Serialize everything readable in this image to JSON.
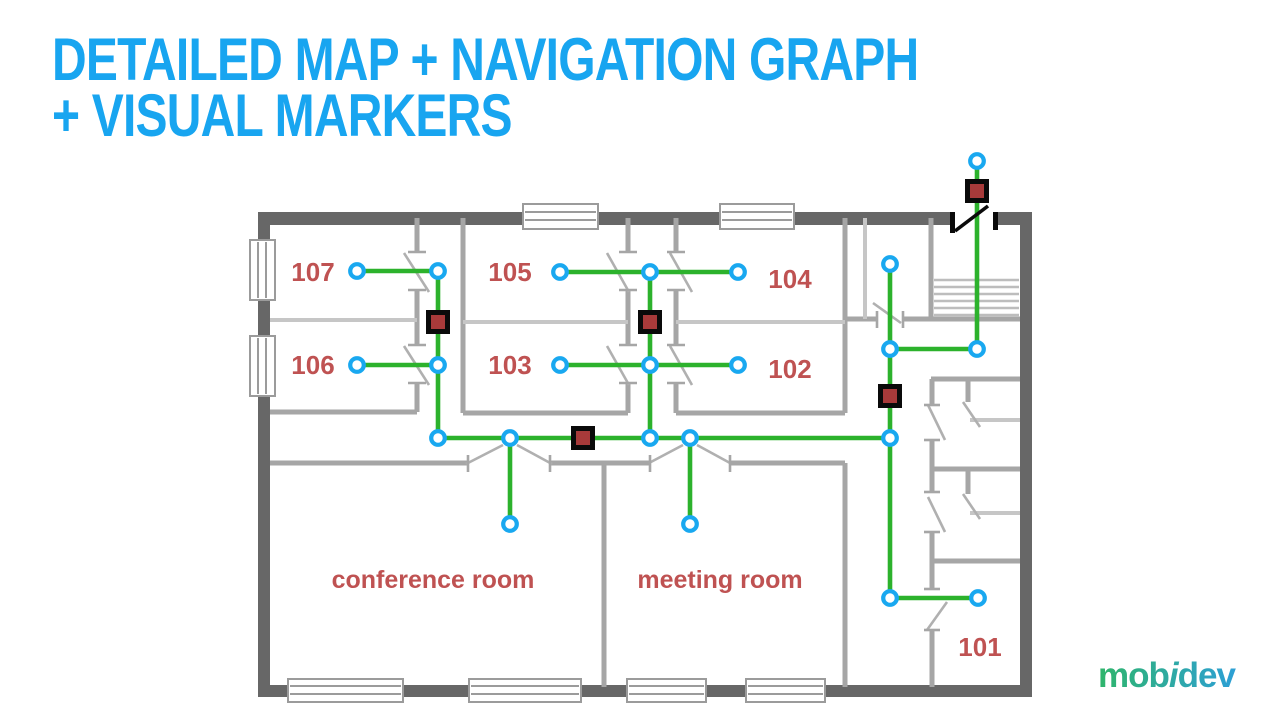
{
  "slide": {
    "title_line1": "DETAILED MAP + NAVIGATION GRAPH",
    "title_line2": "+ VISUAL MARKERS"
  },
  "logo": {
    "pre": "mob",
    "accent": "i",
    "post": "dev"
  },
  "colors": {
    "title": "#18a5f0",
    "edge": "#2cb22c",
    "node": "#19a8f0",
    "marker_fill": "#a83a3a",
    "marker_border": "#0a0a0a",
    "room_label": "#bf5252",
    "wall_outer": "#676767",
    "wall_inner": "#a6a6a6",
    "logo_green": "#2fb56b",
    "logo_blue": "#2d9fd6"
  },
  "map": {
    "room_labels": [
      {
        "id": "107",
        "text": "107",
        "x": 313,
        "y": 281,
        "size": 26
      },
      {
        "id": "106",
        "text": "106",
        "x": 313,
        "y": 374,
        "size": 26
      },
      {
        "id": "105",
        "text": "105",
        "x": 510,
        "y": 281,
        "size": 26
      },
      {
        "id": "103",
        "text": "103",
        "x": 510,
        "y": 374,
        "size": 26
      },
      {
        "id": "104",
        "text": "104",
        "x": 790,
        "y": 288,
        "size": 26
      },
      {
        "id": "102",
        "text": "102",
        "x": 790,
        "y": 378,
        "size": 26
      },
      {
        "id": "101",
        "text": "101",
        "x": 980,
        "y": 656,
        "size": 26
      },
      {
        "id": "conference-room",
        "text": "conference room",
        "x": 433,
        "y": 588,
        "size": 25
      },
      {
        "id": "meeting-room",
        "text": "meeting room",
        "x": 720,
        "y": 588,
        "size": 25
      }
    ],
    "nodes": [
      {
        "id": "room-107",
        "x": 357,
        "y": 271
      },
      {
        "id": "door-107",
        "x": 438,
        "y": 271
      },
      {
        "id": "room-106",
        "x": 357,
        "y": 365
      },
      {
        "id": "door-106",
        "x": 438,
        "y": 365
      },
      {
        "id": "room-105",
        "x": 560,
        "y": 272
      },
      {
        "id": "door-105",
        "x": 650,
        "y": 272
      },
      {
        "id": "room-104",
        "x": 738,
        "y": 272
      },
      {
        "id": "room-103",
        "x": 560,
        "y": 365
      },
      {
        "id": "door-103",
        "x": 650,
        "y": 365
      },
      {
        "id": "room-102",
        "x": 738,
        "y": 365
      },
      {
        "id": "corridor-left",
        "x": 438,
        "y": 438
      },
      {
        "id": "conference-door",
        "x": 510,
        "y": 438
      },
      {
        "id": "conference-inner",
        "x": 510,
        "y": 524
      },
      {
        "id": "corridor-mid",
        "x": 650,
        "y": 438
      },
      {
        "id": "meeting-door",
        "x": 690,
        "y": 438
      },
      {
        "id": "meeting-inner",
        "x": 690,
        "y": 524
      },
      {
        "id": "corridor-right",
        "x": 890,
        "y": 438
      },
      {
        "id": "vestibule",
        "x": 890,
        "y": 264
      },
      {
        "id": "stairs-junction",
        "x": 890,
        "y": 349
      },
      {
        "id": "stairs-bottom",
        "x": 977,
        "y": 349
      },
      {
        "id": "exit",
        "x": 977,
        "y": 161
      },
      {
        "id": "hall-bottom",
        "x": 890,
        "y": 598
      },
      {
        "id": "room-101-door",
        "x": 978,
        "y": 598
      }
    ],
    "edges": [
      [
        "room-107",
        "door-107"
      ],
      [
        "room-106",
        "door-106"
      ],
      [
        "door-107",
        "door-106"
      ],
      [
        "door-106",
        "corridor-left"
      ],
      [
        "room-105",
        "door-105"
      ],
      [
        "door-105",
        "room-104"
      ],
      [
        "room-103",
        "door-103"
      ],
      [
        "door-103",
        "room-102"
      ],
      [
        "door-105",
        "door-103"
      ],
      [
        "door-103",
        "corridor-mid"
      ],
      [
        "corridor-left",
        "conference-door"
      ],
      [
        "conference-door",
        "corridor-mid"
      ],
      [
        "corridor-mid",
        "meeting-door"
      ],
      [
        "meeting-door",
        "corridor-right"
      ],
      [
        "conference-door",
        "conference-inner"
      ],
      [
        "meeting-door",
        "meeting-inner"
      ],
      [
        "vestibule",
        "stairs-junction"
      ],
      [
        "stairs-junction",
        "corridor-right"
      ],
      [
        "corridor-right",
        "hall-bottom"
      ],
      [
        "stairs-junction",
        "stairs-bottom"
      ],
      [
        "stairs-bottom",
        "exit"
      ],
      [
        "hall-bottom",
        "room-101-door"
      ]
    ],
    "markers": [
      {
        "id": "visual-marker-1",
        "x": 438,
        "y": 322
      },
      {
        "id": "visual-marker-2",
        "x": 650,
        "y": 322
      },
      {
        "id": "visual-marker-3",
        "x": 583,
        "y": 438
      },
      {
        "id": "visual-marker-4",
        "x": 890,
        "y": 396
      },
      {
        "id": "visual-marker-5",
        "x": 977,
        "y": 191
      }
    ]
  }
}
